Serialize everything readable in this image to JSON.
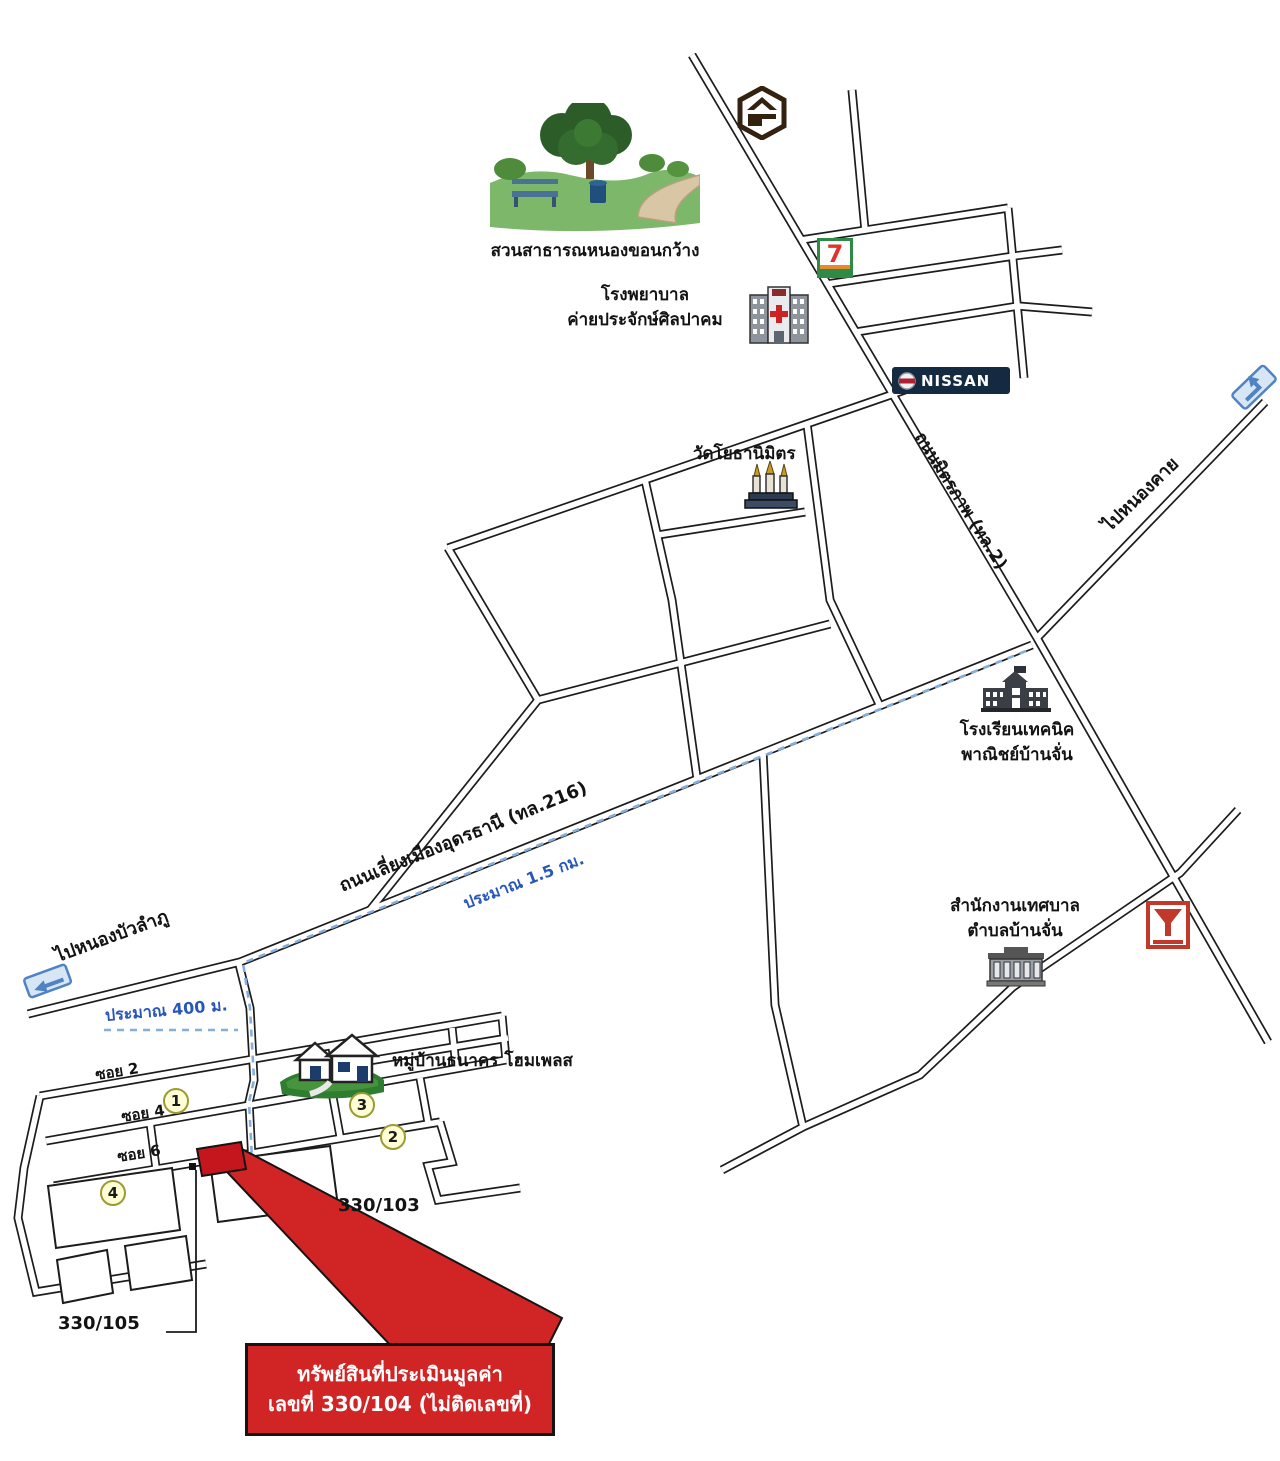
{
  "canvas": {
    "width": 1280,
    "height": 1461
  },
  "landmarks": {
    "park": {
      "name": "สวนสาธารณหนองขอนกว้าง"
    },
    "hospital": {
      "name_line1": "โรงพยาบาล",
      "name_line2": "ค่ายประจักษ์ศิลปาคม"
    },
    "seven_eleven": {
      "logo_text": "7"
    },
    "nissan": {
      "sign_text": "NISSAN"
    },
    "temple": {
      "name": "วัดโยธานิมิตร"
    },
    "school": {
      "name_line1": "โรงเรียนเทคนิค",
      "name_line2": "พาณิชย์บ้านจั่น"
    },
    "municipal_office": {
      "name_line1": "สำนักงานเทศบาล",
      "name_line2": "ตำบลบ้านจั่น"
    },
    "village": {
      "name": "หมู่บ้านธนาคร โฮมเพลส"
    }
  },
  "roads": {
    "mittraphap": {
      "label": "ถนนมิตรภาพ (ทล.2)"
    },
    "bypass": {
      "label": "ถนนเลี่ยงเมืองอุดรธานี (ทล.216)"
    },
    "soi_2": "ซอย 2",
    "soi_4": "ซอย 4",
    "soi_6": "ซอย 6"
  },
  "directions": {
    "nong_khai": "ไปหนองคาย",
    "nong_bua_lamphu": "ไปหนองบัวลำภู"
  },
  "distances": {
    "bypass_leg": "ประมาณ 1.5 กม.",
    "access_leg": "ประมาณ 400 ม."
  },
  "plot_markers": [
    "1",
    "3",
    "2",
    "4"
  ],
  "house_numbers": {
    "right": "330/103",
    "left": "330/105"
  },
  "property_banner": {
    "line1": "ทรัพย์สินที่ประเมินมูลค่า",
    "line2": "เลขที่ 330/104 (ไม่ติดเลขที่)"
  },
  "colors": {
    "road_outline": "#1c1c1c",
    "route_blue": "#85aedd",
    "distance_text_blue": "#2857b8",
    "banner_red": "#d02425",
    "marker_yellow": "#fffdd4",
    "nissan_navy": "#142a40",
    "seven_green": "#2e8b46"
  }
}
